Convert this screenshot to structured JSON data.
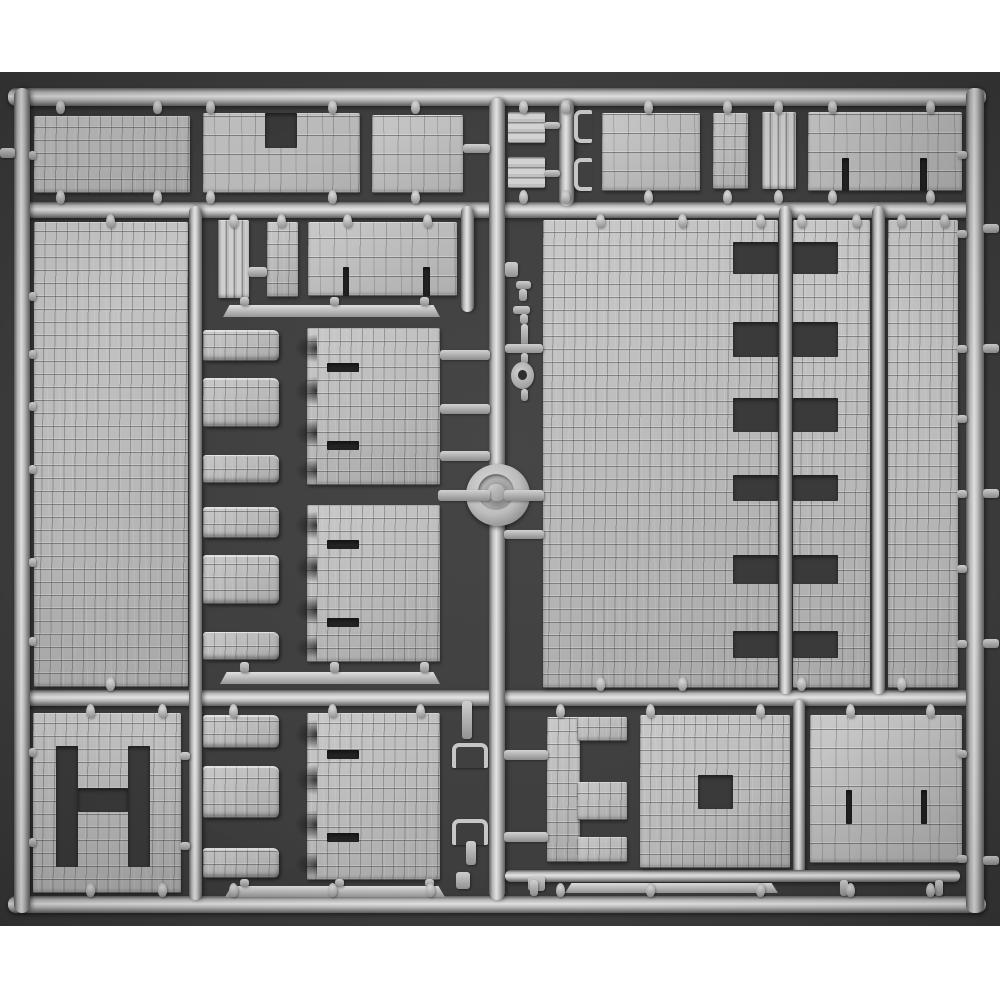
{
  "scene": {
    "subject": "gray-plastic-model-kit-sprue-with-stone-wall-panels",
    "palette": {
      "page_bg": "#ffffff",
      "photo_bg": "#3e3e3e",
      "photo_bg_edge": "#373737",
      "plastic_highlight": "#e4e4e4",
      "plastic_mid": "#bcbcbc",
      "plastic_shadow": "#5f5f5f",
      "opening_dark": "#3a3a3a",
      "slit_dark": "#242424"
    },
    "photo_area": {
      "x": 0,
      "y": 72,
      "w": 1000,
      "h": 854
    },
    "parts": [
      {
        "name": "top-rail",
        "type": "railh",
        "x": 8,
        "y": 88,
        "w": 978,
        "h": 18
      },
      {
        "name": "horizontal-rail-2",
        "type": "railh",
        "x": 22,
        "y": 202,
        "w": 950,
        "h": 16
      },
      {
        "name": "horizontal-rail-3",
        "type": "railh",
        "x": 22,
        "y": 690,
        "w": 950,
        "h": 16
      },
      {
        "name": "bottom-rail",
        "type": "railh",
        "x": 8,
        "y": 896,
        "w": 978,
        "h": 17
      },
      {
        "name": "left-rail",
        "type": "railv",
        "x": 14,
        "y": 88,
        "w": 16,
        "h": 825
      },
      {
        "name": "right-rail",
        "type": "railv",
        "x": 966,
        "y": 88,
        "w": 18,
        "h": 825
      },
      {
        "name": "center-runner",
        "type": "railv",
        "x": 489,
        "y": 98,
        "w": 16,
        "h": 802
      },
      {
        "name": "clip-runner-top",
        "type": "railv",
        "x": 559,
        "y": 100,
        "w": 15,
        "h": 106
      },
      {
        "name": "left-mid-runner",
        "type": "railv",
        "x": 189,
        "y": 206,
        "w": 13,
        "h": 694
      },
      {
        "name": "mid-runner-a",
        "type": "railv",
        "x": 779,
        "y": 206,
        "w": 13,
        "h": 488
      },
      {
        "name": "mid-runner-b",
        "type": "railv",
        "x": 872,
        "y": 206,
        "w": 13,
        "h": 488
      },
      {
        "name": "top-mid-runner",
        "type": "railv",
        "x": 461,
        "y": 206,
        "w": 13,
        "h": 106
      },
      {
        "name": "bottom-right-runner",
        "type": "railv",
        "x": 793,
        "y": 700,
        "w": 12,
        "h": 176
      },
      {
        "name": "bottom-sub-rail",
        "type": "railh",
        "x": 505,
        "y": 870,
        "w": 455,
        "h": 12
      },
      {
        "name": "wall-panel-top-1",
        "type": "cobble",
        "x": 34,
        "y": 116,
        "w": 156,
        "h": 77
      },
      {
        "name": "wall-panel-top-2-notched",
        "type": "brick",
        "x": 203,
        "y": 113,
        "w": 157,
        "h": 80,
        "cutouts": [
          {
            "x": 62,
            "y": 0,
            "w": 32,
            "h": 35
          }
        ]
      },
      {
        "name": "wall-panel-top-3",
        "type": "brick",
        "x": 372,
        "y": 115,
        "w": 91,
        "h": 78
      },
      {
        "name": "plank-bar-1",
        "type": "planksh",
        "x": 508,
        "y": 112,
        "w": 37,
        "h": 31
      },
      {
        "name": "plank-bar-2",
        "type": "planksh",
        "x": 508,
        "y": 157,
        "w": 37,
        "h": 31
      },
      {
        "name": "hook-clip-1",
        "type": "clip",
        "x": 574,
        "y": 110,
        "w": 18,
        "h": 33
      },
      {
        "name": "hook-clip-2",
        "type": "clip",
        "x": 574,
        "y": 158,
        "w": 18,
        "h": 33
      },
      {
        "name": "wall-panel-top-4",
        "type": "brick",
        "x": 602,
        "y": 113,
        "w": 98,
        "h": 78
      },
      {
        "name": "wall-column-top-5",
        "type": "cobble",
        "x": 713,
        "y": 113,
        "w": 35,
        "h": 76
      },
      {
        "name": "plank-door-top",
        "type": "planksv",
        "x": 762,
        "y": 112,
        "w": 34,
        "h": 77
      },
      {
        "name": "wall-panel-top-6-gated",
        "type": "brick",
        "x": 808,
        "y": 112,
        "w": 154,
        "h": 79,
        "cutouts": [
          {
            "x": 34,
            "y": 46,
            "w": 7,
            "h": 33
          },
          {
            "x": 112,
            "y": 46,
            "w": 7,
            "h": 33
          }
        ]
      },
      {
        "name": "wall-panel-left-large",
        "type": "cobble",
        "x": 34,
        "y": 222,
        "w": 154,
        "h": 465
      },
      {
        "name": "plank-door-mid",
        "type": "planksv",
        "x": 218,
        "y": 220,
        "w": 31,
        "h": 78
      },
      {
        "name": "wall-block-mid",
        "type": "cobble",
        "x": 267,
        "y": 222,
        "w": 31,
        "h": 75
      },
      {
        "name": "wall-panel-mid-gated",
        "type": "brick",
        "x": 308,
        "y": 222,
        "w": 149,
        "h": 74,
        "cutouts": [
          {
            "x": 35,
            "y": 45,
            "w": 6,
            "h": 29
          },
          {
            "x": 115,
            "y": 45,
            "w": 7,
            "h": 29
          }
        ]
      },
      {
        "name": "beam-strip-1",
        "type": "strip",
        "x": 223,
        "y": 305,
        "w": 217,
        "h": 12
      },
      {
        "name": "machicolation-panel-1",
        "type": "mach",
        "x": 203,
        "y": 328,
        "w": 237,
        "h": 157
      },
      {
        "name": "machicolation-panel-2",
        "type": "mach",
        "x": 203,
        "y": 505,
        "w": 237,
        "h": 157
      },
      {
        "name": "beam-strip-2",
        "type": "strip",
        "x": 220,
        "y": 672,
        "w": 220,
        "h": 12
      },
      {
        "name": "wall-panel-center-large",
        "type": "cobble",
        "x": 543,
        "y": 220,
        "w": 235,
        "h": 468,
        "cutouts": [
          {
            "x": 190,
            "y": 22,
            "w": 45,
            "h": 32
          },
          {
            "x": 190,
            "y": 102,
            "w": 45,
            "h": 35
          },
          {
            "x": 190,
            "y": 178,
            "w": 45,
            "h": 34
          },
          {
            "x": 190,
            "y": 255,
            "w": 45,
            "h": 26
          },
          {
            "x": 190,
            "y": 335,
            "w": 45,
            "h": 29
          },
          {
            "x": 190,
            "y": 411,
            "w": 45,
            "h": 27
          }
        ]
      },
      {
        "name": "wall-panel-center-right",
        "type": "cobble",
        "x": 793,
        "y": 220,
        "w": 77,
        "h": 468,
        "cutouts": [
          {
            "x": 0,
            "y": 22,
            "w": 45,
            "h": 32
          },
          {
            "x": 0,
            "y": 102,
            "w": 45,
            "h": 35
          },
          {
            "x": 0,
            "y": 178,
            "w": 45,
            "h": 34
          },
          {
            "x": 0,
            "y": 255,
            "w": 45,
            "h": 26
          },
          {
            "x": 0,
            "y": 335,
            "w": 45,
            "h": 29
          },
          {
            "x": 0,
            "y": 411,
            "w": 45,
            "h": 27
          }
        ]
      },
      {
        "name": "wall-panel-right-tall",
        "type": "cobble",
        "x": 888,
        "y": 220,
        "w": 70,
        "h": 468
      },
      {
        "name": "chain-square",
        "type": "bar",
        "x": 505,
        "y": 262,
        "w": 13,
        "h": 15
      },
      {
        "name": "chain-elbow-1",
        "type": "bar",
        "x": 516,
        "y": 281,
        "w": 15,
        "h": 8
      },
      {
        "name": "chain-elbow-1b",
        "type": "bar",
        "x": 519,
        "y": 289,
        "w": 8,
        "h": 12
      },
      {
        "name": "chain-elbow-2",
        "type": "bar",
        "x": 513,
        "y": 306,
        "w": 17,
        "h": 8
      },
      {
        "name": "chain-elbow-2b",
        "type": "bar",
        "x": 520,
        "y": 314,
        "w": 8,
        "h": 10
      },
      {
        "name": "chain-stem-1",
        "type": "bar",
        "x": 521,
        "y": 324,
        "w": 7,
        "h": 22
      },
      {
        "name": "chain-cross-stub",
        "type": "bar",
        "x": 505,
        "y": 344,
        "w": 38,
        "h": 9
      },
      {
        "name": "chain-stem-2",
        "type": "bar",
        "x": 521,
        "y": 353,
        "w": 7,
        "h": 11
      },
      {
        "name": "chain-eyelet",
        "type": "eyelet",
        "x": 511,
        "y": 362,
        "w": 23,
        "h": 27
      },
      {
        "name": "chain-stem-3",
        "type": "bar",
        "x": 521,
        "y": 389,
        "w": 7,
        "h": 12
      },
      {
        "name": "sprue-gate-knob",
        "type": "knob",
        "x": 466,
        "y": 464,
        "w": 64,
        "h": 62
      },
      {
        "name": "wall-panel-h-openings",
        "type": "cobble",
        "x": 33,
        "y": 713,
        "w": 148,
        "h": 180,
        "cutouts": [
          {
            "x": 23,
            "y": 33,
            "w": 22,
            "h": 121
          },
          {
            "x": 95,
            "y": 33,
            "w": 22,
            "h": 121
          },
          {
            "x": 45,
            "y": 75,
            "w": 50,
            "h": 24
          }
        ]
      },
      {
        "name": "machicolation-panel-3",
        "type": "mach",
        "x": 203,
        "y": 713,
        "w": 237,
        "h": 167
      },
      {
        "name": "beam-strip-3",
        "type": "strip",
        "x": 225,
        "y": 886,
        "w": 220,
        "h": 11
      },
      {
        "name": "hook-clip-3",
        "type": "cliph",
        "x": 452,
        "y": 743,
        "w": 36,
        "h": 25
      },
      {
        "name": "hook-clip-4",
        "type": "cliph",
        "x": 452,
        "y": 819,
        "w": 36,
        "h": 26
      },
      {
        "name": "pin-bar-1",
        "type": "bar",
        "x": 462,
        "y": 701,
        "w": 10,
        "h": 38
      },
      {
        "name": "pin-bar-2",
        "type": "bar",
        "x": 466,
        "y": 841,
        "w": 10,
        "h": 24
      },
      {
        "name": "small-block-1",
        "type": "bar",
        "x": 456,
        "y": 872,
        "w": 14,
        "h": 17
      },
      {
        "name": "small-block-2",
        "type": "bar",
        "x": 528,
        "y": 876,
        "w": 17,
        "h": 15
      },
      {
        "name": "bracket-panel-e",
        "type": "epanel",
        "x": 547,
        "y": 717,
        "w": 80,
        "h": 145
      },
      {
        "name": "window-panel-square",
        "type": "cobble",
        "x": 640,
        "y": 715,
        "w": 150,
        "h": 153,
        "cutouts": [
          {
            "x": 58,
            "y": 60,
            "w": 35,
            "h": 34
          }
        ]
      },
      {
        "name": "wall-panel-bottom-right",
        "type": "brick",
        "x": 810,
        "y": 715,
        "w": 152,
        "h": 148,
        "cutouts": [
          {
            "x": 36,
            "y": 75,
            "w": 6,
            "h": 34
          },
          {
            "x": 111,
            "y": 75,
            "w": 6,
            "h": 34
          }
        ]
      },
      {
        "name": "beam-strip-4",
        "type": "strip",
        "x": 565,
        "y": 883,
        "w": 213,
        "h": 10
      }
    ],
    "pins": [
      [
        60,
        100
      ],
      [
        157,
        100
      ],
      [
        210,
        100
      ],
      [
        332,
        100
      ],
      [
        415,
        100
      ],
      [
        523,
        100
      ],
      [
        565,
        100
      ],
      [
        648,
        100
      ],
      [
        727,
        100
      ],
      [
        778,
        100
      ],
      [
        832,
        100
      ],
      [
        930,
        100
      ],
      [
        60,
        190
      ],
      [
        157,
        190
      ],
      [
        210,
        190
      ],
      [
        332,
        190
      ],
      [
        415,
        190
      ],
      [
        523,
        190
      ],
      [
        565,
        190
      ],
      [
        648,
        190
      ],
      [
        727,
        190
      ],
      [
        778,
        190
      ],
      [
        832,
        190
      ],
      [
        930,
        190
      ],
      [
        110,
        214
      ],
      [
        233,
        214
      ],
      [
        281,
        214
      ],
      [
        347,
        214
      ],
      [
        427,
        214
      ],
      [
        600,
        214
      ],
      [
        682,
        214
      ],
      [
        760,
        214
      ],
      [
        801,
        214
      ],
      [
        856,
        214
      ],
      [
        901,
        214
      ],
      [
        944,
        214
      ],
      [
        110,
        677
      ],
      [
        600,
        677
      ],
      [
        682,
        677
      ],
      [
        801,
        677
      ],
      [
        901,
        677
      ],
      [
        90,
        704
      ],
      [
        162,
        704
      ],
      [
        233,
        704
      ],
      [
        332,
        704
      ],
      [
        420,
        704
      ],
      [
        560,
        704
      ],
      [
        650,
        704
      ],
      [
        760,
        704
      ],
      [
        850,
        704
      ],
      [
        930,
        704
      ],
      [
        90,
        883
      ],
      [
        162,
        883
      ],
      [
        233,
        883
      ],
      [
        332,
        883
      ],
      [
        430,
        883
      ],
      [
        560,
        883
      ],
      [
        650,
        883
      ],
      [
        760,
        883
      ],
      [
        850,
        883
      ],
      [
        930,
        883
      ]
    ],
    "stubs": [
      [
        0,
        148,
        15,
        10
      ],
      [
        29,
        151,
        7,
        9
      ],
      [
        29,
        292,
        7,
        9
      ],
      [
        29,
        350,
        7,
        9
      ],
      [
        29,
        402,
        7,
        9
      ],
      [
        29,
        465,
        7,
        9
      ],
      [
        29,
        558,
        7,
        9
      ],
      [
        29,
        637,
        7,
        9
      ],
      [
        29,
        748,
        7,
        9
      ],
      [
        29,
        838,
        7,
        9
      ],
      [
        957,
        151,
        10,
        8
      ],
      [
        957,
        230,
        10,
        8
      ],
      [
        957,
        345,
        10,
        8
      ],
      [
        957,
        415,
        10,
        8
      ],
      [
        957,
        490,
        10,
        8
      ],
      [
        957,
        565,
        10,
        8
      ],
      [
        957,
        640,
        10,
        8
      ],
      [
        957,
        750,
        10,
        8
      ],
      [
        957,
        855,
        10,
        8
      ],
      [
        983,
        224,
        16,
        9
      ],
      [
        983,
        344,
        16,
        9
      ],
      [
        983,
        489,
        16,
        9
      ],
      [
        983,
        639,
        16,
        9
      ],
      [
        983,
        856,
        16,
        9
      ],
      [
        440,
        350,
        50,
        10
      ],
      [
        440,
        404,
        50,
        10
      ],
      [
        440,
        451,
        50,
        10
      ],
      [
        438,
        490,
        52,
        11
      ],
      [
        504,
        490,
        40,
        11
      ],
      [
        504,
        530,
        40,
        9
      ],
      [
        463,
        144,
        27,
        9
      ],
      [
        544,
        122,
        16,
        7
      ],
      [
        544,
        170,
        16,
        7
      ],
      [
        180,
        752,
        10,
        8
      ],
      [
        180,
        842,
        10,
        8
      ],
      [
        504,
        750,
        44,
        10
      ],
      [
        504,
        832,
        44,
        10
      ],
      [
        240,
        297,
        9,
        9
      ],
      [
        330,
        297,
        9,
        9
      ],
      [
        420,
        297,
        9,
        9
      ],
      [
        240,
        662,
        9,
        11
      ],
      [
        330,
        662,
        9,
        11
      ],
      [
        420,
        662,
        9,
        11
      ],
      [
        240,
        879,
        9,
        8
      ],
      [
        335,
        879,
        9,
        8
      ],
      [
        425,
        879,
        9,
        8
      ],
      [
        248,
        267,
        19,
        10
      ],
      [
        530,
        880,
        8,
        16
      ],
      [
        840,
        880,
        8,
        16
      ],
      [
        935,
        880,
        8,
        16
      ]
    ]
  }
}
